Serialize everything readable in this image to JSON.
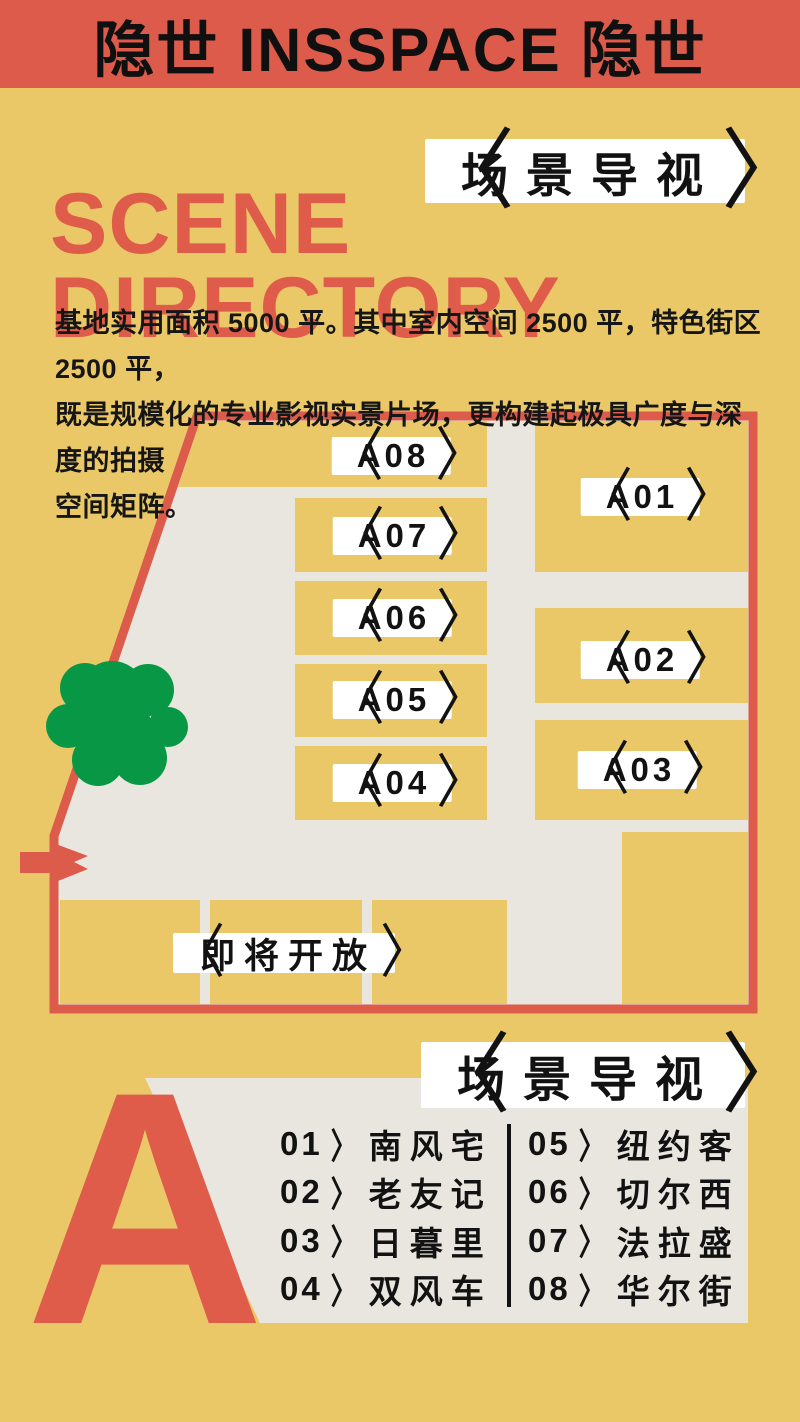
{
  "banner": {
    "title": "隐世 INSSPACE 隐世"
  },
  "title": {
    "line1": "SCENE",
    "line2": "DIRECTORY"
  },
  "badge_top": {
    "text": "场景导视"
  },
  "intro": {
    "lines": [
      "基地实用面积 5000 平。其中室内空间 2500 平，特色街区 2500 平，",
      "既是规模化的专业影视实景片场，更构建起极具广度与深度的拍摄",
      "空间矩阵。"
    ]
  },
  "symbols": {
    "left_bracket": "〈",
    "right_bracket": "〉"
  },
  "map": {
    "blocks": {
      "a01": "A01",
      "a02": "A02",
      "a03": "A03",
      "a04": "A04",
      "a05": "A05",
      "a06": "A06",
      "a07": "A07",
      "a08": "A08"
    },
    "coming_soon": "即将开放"
  },
  "section_a": {
    "letter": "A",
    "badge": {
      "text": "场景导视"
    },
    "legend": {
      "col1": [
        {
          "num": "01",
          "name": "南风宅"
        },
        {
          "num": "02",
          "name": "老友记"
        },
        {
          "num": "03",
          "name": "日暮里"
        },
        {
          "num": "04",
          "name": "双风车"
        }
      ],
      "col2": [
        {
          "num": "05",
          "name": "纽约客"
        },
        {
          "num": "06",
          "name": "切尔西"
        },
        {
          "num": "07",
          "name": "法拉盛"
        },
        {
          "num": "08",
          "name": "华尔街"
        }
      ]
    }
  },
  "colors": {
    "coral_red": "#DC5B4B",
    "mustard_yellow": "#EAC868",
    "panel_gray": "#E9E6DF",
    "tree_green": "#089845",
    "ink_black": "#121212",
    "white": "#FFFFFF"
  }
}
